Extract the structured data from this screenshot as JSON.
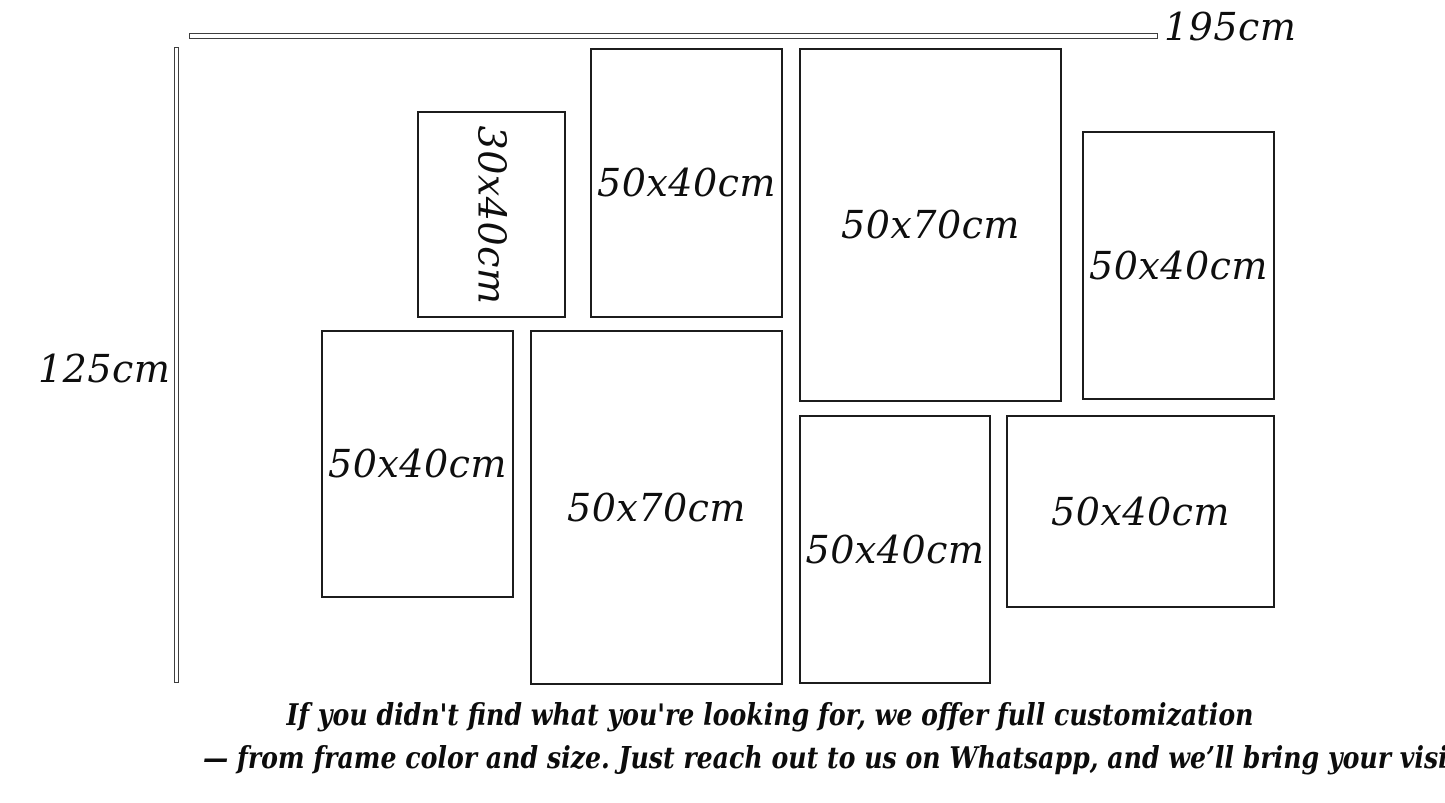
{
  "canvas": {
    "background_color": "#ffffff",
    "ink_color": "#0e0e0e"
  },
  "dimensions": {
    "width_label": "195cm",
    "height_label": "125cm"
  },
  "frames": [
    {
      "label": "30x40cm",
      "orientation": "portrait",
      "label_rotated": true
    },
    {
      "label": "50x40cm",
      "orientation": "portrait",
      "label_rotated": false
    },
    {
      "label": "50x70cm",
      "orientation": "portrait",
      "label_rotated": false
    },
    {
      "label": "50x40cm",
      "orientation": "portrait",
      "label_rotated": false
    },
    {
      "label": "50x40cm",
      "orientation": "portrait",
      "label_rotated": false
    },
    {
      "label": "50x70cm",
      "orientation": "portrait",
      "label_rotated": false
    },
    {
      "label": "50x40cm",
      "orientation": "portrait",
      "label_rotated": false
    },
    {
      "label": "50x40cm",
      "orientation": "landscape",
      "label_rotated": false
    }
  ],
  "footer": {
    "line1": "If you didn't find what you're looking for, we offer full customization",
    "line2": "— from frame color and size. Just reach out to us on Whatsapp, and we’ll bring your vision to life!"
  }
}
